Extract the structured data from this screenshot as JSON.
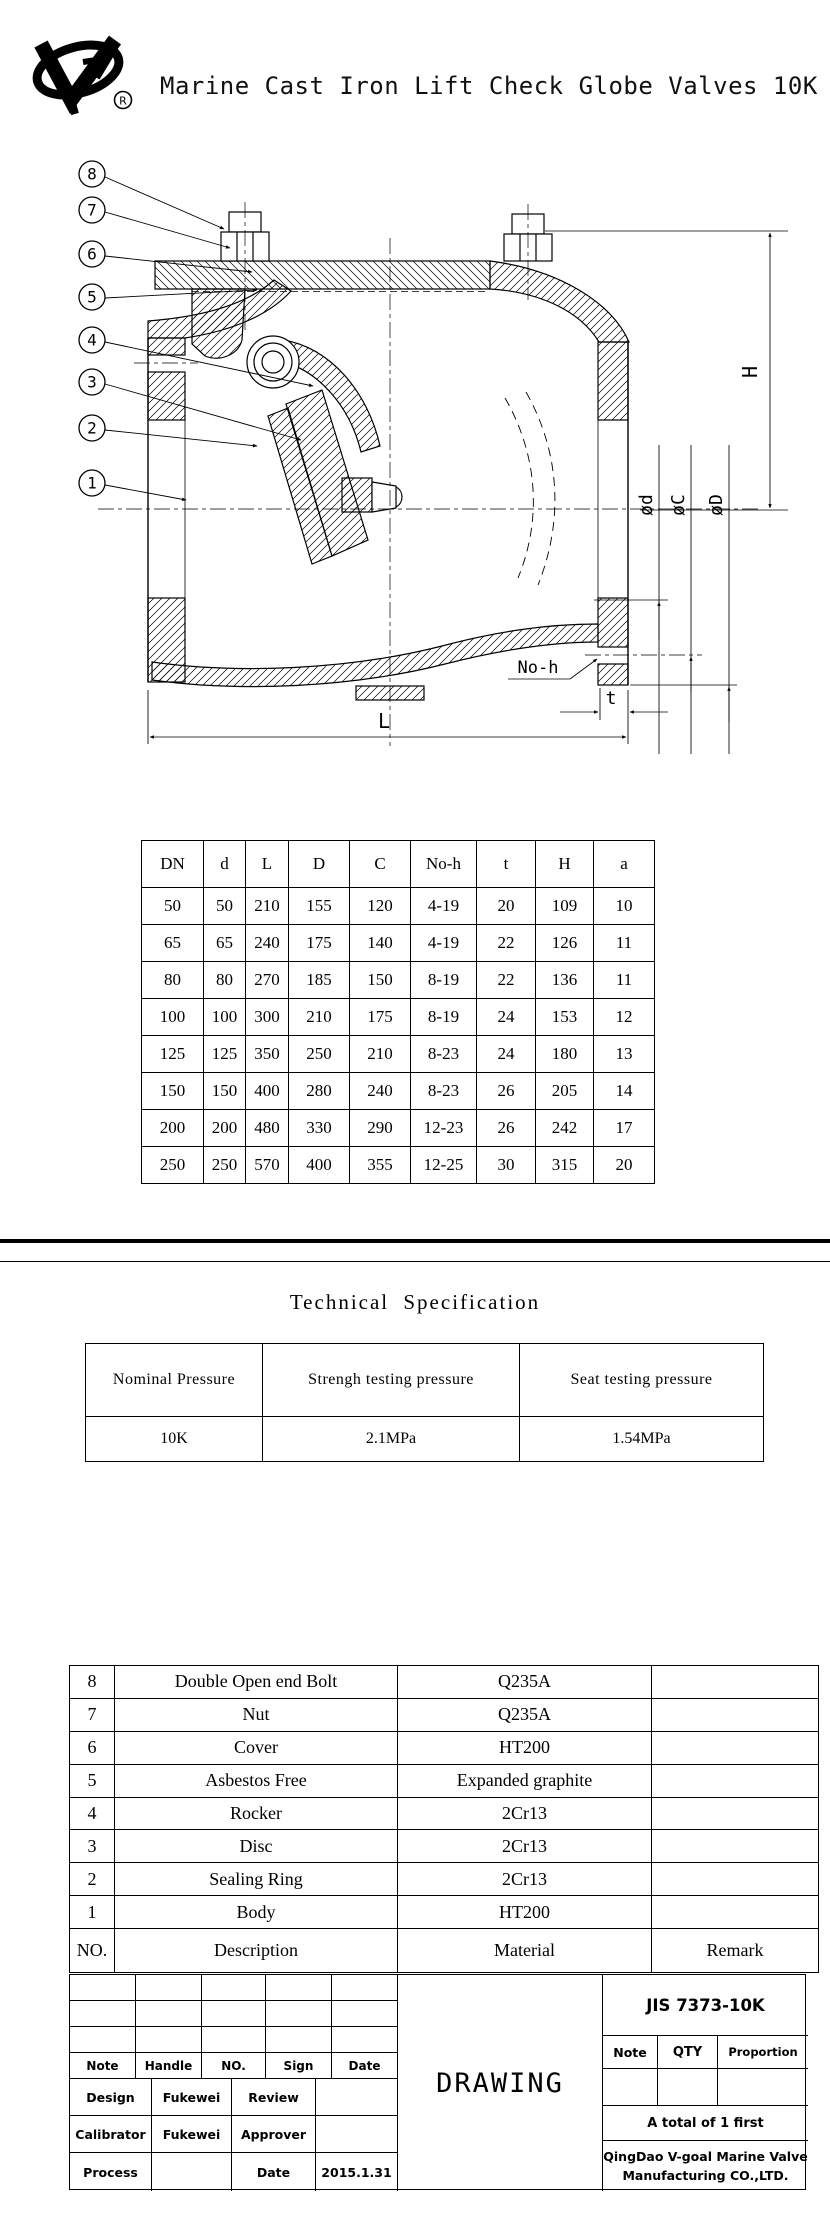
{
  "header": {
    "title": "Marine Cast Iron Lift Check Globe Valves 10K",
    "registered_mark": "R"
  },
  "drawing": {
    "callouts": [
      "8",
      "7",
      "6",
      "5",
      "4",
      "3",
      "2",
      "1"
    ],
    "dims": {
      "H": "H",
      "L": "L",
      "t": "t",
      "noh": "No-h",
      "phid": "ød",
      "phic": "øC",
      "phiD": "øD"
    }
  },
  "dimension_table": {
    "headers": [
      "DN",
      "d",
      "L",
      "D",
      "C",
      "No-h",
      "t",
      "H",
      "a"
    ],
    "rows": [
      [
        "50",
        "50",
        "210",
        "155",
        "120",
        "4-19",
        "20",
        "109",
        "10"
      ],
      [
        "65",
        "65",
        "240",
        "175",
        "140",
        "4-19",
        "22",
        "126",
        "11"
      ],
      [
        "80",
        "80",
        "270",
        "185",
        "150",
        "8-19",
        "22",
        "136",
        "11"
      ],
      [
        "100",
        "100",
        "300",
        "210",
        "175",
        "8-19",
        "24",
        "153",
        "12"
      ],
      [
        "125",
        "125",
        "350",
        "250",
        "210",
        "8-23",
        "24",
        "180",
        "13"
      ],
      [
        "150",
        "150",
        "400",
        "280",
        "240",
        "8-23",
        "26",
        "205",
        "14"
      ],
      [
        "200",
        "200",
        "480",
        "330",
        "290",
        "12-23",
        "26",
        "242",
        "17"
      ],
      [
        "250",
        "250",
        "570",
        "400",
        "355",
        "12-25",
        "30",
        "315",
        "20"
      ]
    ]
  },
  "spec": {
    "heading": "Technical Specification",
    "headers": [
      "Nominal Pressure",
      "Strengh testing pressure",
      "Seat testing pressure"
    ],
    "values": [
      "10K",
      "2.1MPa",
      "1.54MPa"
    ]
  },
  "parts_table": {
    "rows": [
      [
        "8",
        "Double Open end Bolt",
        "Q235A",
        ""
      ],
      [
        "7",
        "Nut",
        "Q235A",
        ""
      ],
      [
        "6",
        "Cover",
        "HT200",
        ""
      ],
      [
        "5",
        "Asbestos Free",
        "Expanded graphite",
        ""
      ],
      [
        "4",
        "Rocker",
        "2Cr13",
        ""
      ],
      [
        "3",
        "Disc",
        "2Cr13",
        ""
      ],
      [
        "2",
        "Sealing Ring",
        "2Cr13",
        ""
      ],
      [
        "1",
        "Body",
        "HT200",
        ""
      ]
    ],
    "footer": [
      "NO.",
      "Description",
      "Material",
      "Remark"
    ]
  },
  "title_block": {
    "note": "Note",
    "handle": "Handle",
    "no": "NO.",
    "sign": "Sign",
    "date": "Date",
    "design": "Design",
    "design_by": "Fukewei",
    "review": "Review",
    "calibrator": "Calibrator",
    "calib_by": "Fukewei",
    "approver": "Approver",
    "process": "Process",
    "date_label": "Date",
    "date_value": "2015.1.31",
    "drawing_label": "DRAWING",
    "standard": "JIS 7373-10K",
    "note2": "Note",
    "qty": "QTY",
    "proportion": "Proportion",
    "total": "A total of 1 first",
    "company_line1": "QingDao V-goal Marine Valve",
    "company_line2": "Manufacturing CO.,LTD."
  }
}
